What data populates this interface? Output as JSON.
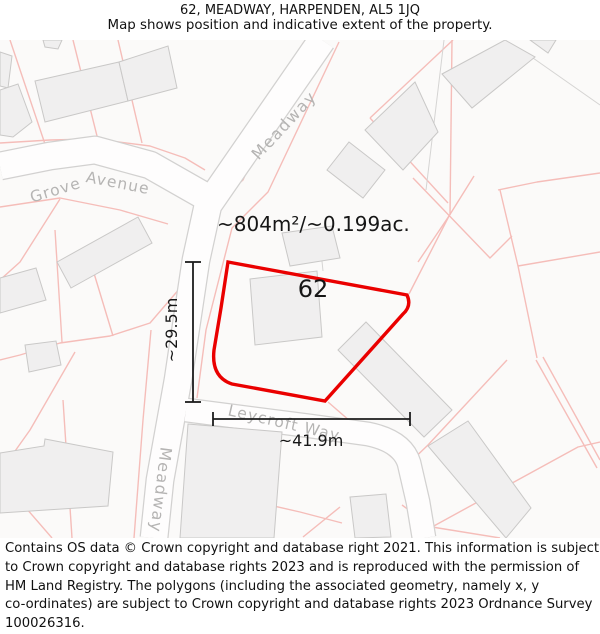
{
  "header": {
    "title": "62, MEADWAY, HARPENDEN, AL5 1JQ",
    "subtitle": "Map shows position and indicative extent of the property."
  },
  "map": {
    "plot_number": "62",
    "area_label": "~804m²/~0.199ac.",
    "dim_vertical": "~29.5m",
    "dim_horizontal": "~41.9m",
    "roads": {
      "grove_word1": "Grove",
      "grove_word2": "Avenue",
      "meadway_upper": "Meadway",
      "meadway_lower": "Meadway",
      "leycroft": "Leycroft Way"
    },
    "colors": {
      "property_outline": "#ea0000",
      "parcel_line": "#f5bdb9",
      "building_fill": "#f0efef",
      "building_stroke": "#c9c8c7",
      "road_casing": "#d2d1d0",
      "road_fill": "#fefdfd",
      "road_label": "#b5b4b3",
      "dimension_line": "#1c1c1c",
      "map_background": "#fbfaf9"
    }
  },
  "footer": {
    "lines": [
      "Contains OS data © Crown copyright and database right 2021. This information is subject",
      "to Crown copyright and database rights 2023 and is reproduced with the permission of",
      "HM Land Registry. The polygons (including the associated geometry, namely x, y",
      "co-ordinates) are subject to Crown copyright and database rights 2023 Ordnance Survey",
      "100026316."
    ]
  }
}
